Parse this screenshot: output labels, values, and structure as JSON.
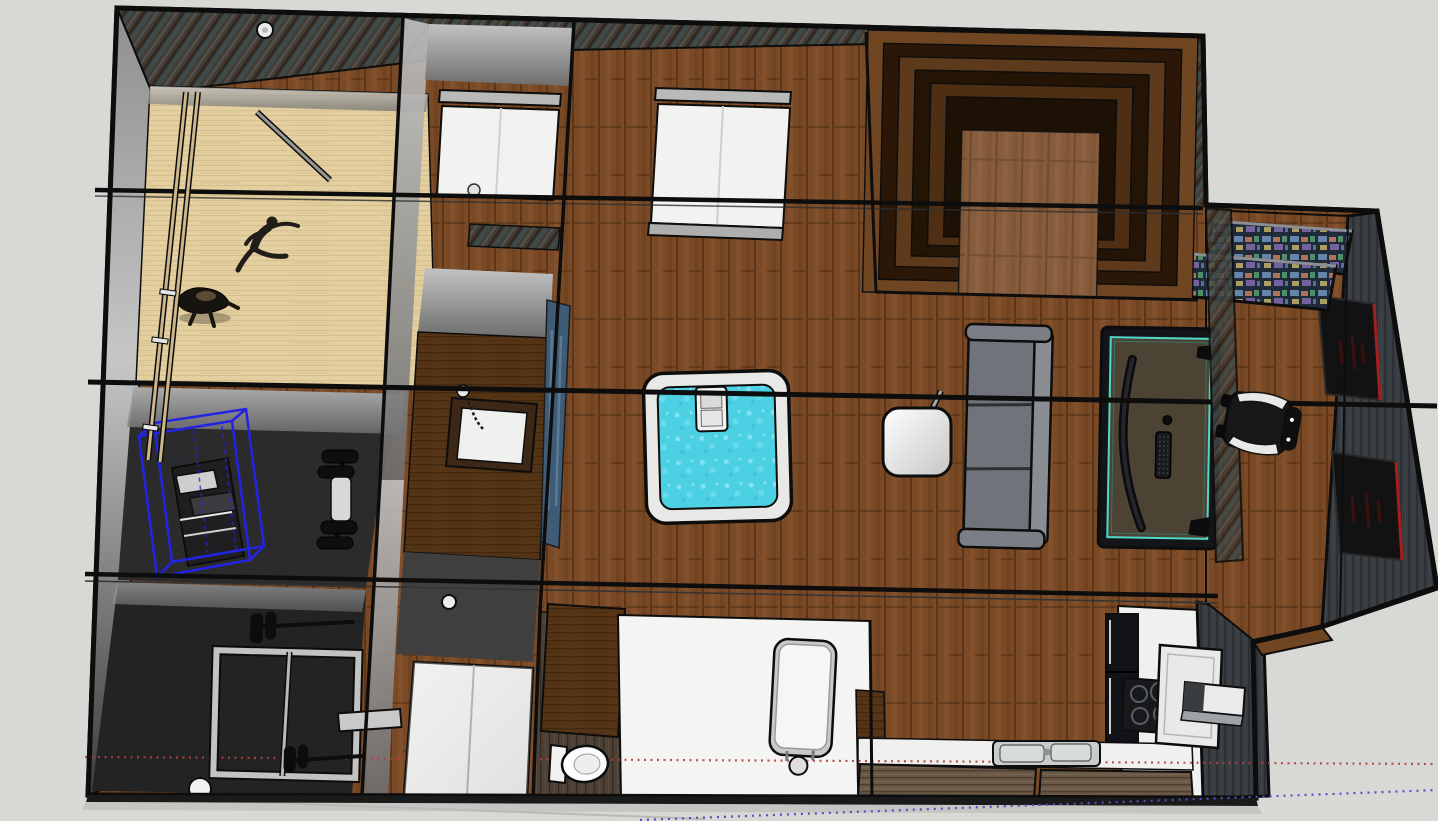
{
  "app": {
    "type": "3d-modeling-viewport",
    "style": "sketchup-like",
    "view": "top-down-perspective-floorplan"
  },
  "selection": {
    "selected_object": "treadmill-machine",
    "selection_style": "blue-bounding-wireframe"
  },
  "axes": {
    "red_axis": {
      "style": "dotted",
      "orientation": "horizontal"
    },
    "blue_axis": {
      "style": "dotted",
      "orientation": "horizontal-sloped"
    }
  },
  "rooms": [
    {
      "id": "dance-studio",
      "floor": "maple"
    },
    {
      "id": "gym-upper",
      "floor": "dark"
    },
    {
      "id": "gym-lower",
      "floor": "dark"
    },
    {
      "id": "small-bedroom",
      "floor": "wood"
    },
    {
      "id": "vanity-room",
      "floor": "dark-wood"
    },
    {
      "id": "laundry-closet",
      "floor": "gray"
    },
    {
      "id": "toilet-room",
      "floor": "dark-plank"
    },
    {
      "id": "bathroom",
      "floor": "white"
    },
    {
      "id": "living-area",
      "floor": "wood-plank"
    },
    {
      "id": "open-bedroom",
      "floor": "wood-plank"
    },
    {
      "id": "tiered-lounge",
      "floor": "stepped-wood"
    },
    {
      "id": "kitchen",
      "floor": "white"
    },
    {
      "id": "gaming-annex",
      "floor": "wood-plank"
    }
  ],
  "objects": [
    {
      "id": "ballet-barre",
      "room": "dance-studio"
    },
    {
      "id": "stretch-rod",
      "room": "dance-studio"
    },
    {
      "id": "dancer-figure-1",
      "room": "dance-studio"
    },
    {
      "id": "dancer-figure-2",
      "room": "dance-studio"
    },
    {
      "id": "treadmill-machine",
      "room": "gym-upper",
      "selected": true
    },
    {
      "id": "dumbbell-rack",
      "room": "gym-upper"
    },
    {
      "id": "squat-rack",
      "room": "gym-lower"
    },
    {
      "id": "round-plate",
      "room": "gym-lower"
    },
    {
      "id": "bed-small",
      "room": "small-bedroom"
    },
    {
      "id": "bed-double",
      "room": "open-bedroom"
    },
    {
      "id": "vanity-sink",
      "room": "vanity-room"
    },
    {
      "id": "hand-shower-hose",
      "room": "vanity-room"
    },
    {
      "id": "wall-art-blue",
      "room": "vanity-room"
    },
    {
      "id": "wardrobe-white",
      "room": "laundry-closet"
    },
    {
      "id": "toilet",
      "room": "toilet-room"
    },
    {
      "id": "bathtub",
      "room": "bathroom"
    },
    {
      "id": "hot-tub",
      "room": "living-area"
    },
    {
      "id": "floor-lamp",
      "room": "living-area"
    },
    {
      "id": "sofa",
      "room": "living-area"
    },
    {
      "id": "gaming-desk",
      "room": "living-area"
    },
    {
      "id": "curved-monitor",
      "room": "living-area"
    },
    {
      "id": "keyboard",
      "room": "living-area"
    },
    {
      "id": "mouse",
      "room": "living-area"
    },
    {
      "id": "gaming-chair",
      "room": "gaming-annex"
    },
    {
      "id": "media-screen-1",
      "room": "gaming-annex"
    },
    {
      "id": "media-screen-2",
      "room": "gaming-annex"
    },
    {
      "id": "poster-1",
      "room": "gaming-annex"
    },
    {
      "id": "poster-2",
      "room": "gaming-annex"
    },
    {
      "id": "kitchen-sink",
      "room": "kitchen"
    },
    {
      "id": "cooktop",
      "room": "kitchen"
    },
    {
      "id": "range-hood",
      "room": "kitchen"
    },
    {
      "id": "appliance-column",
      "room": "kitchen"
    },
    {
      "id": "kitchen-cabinets",
      "room": "kitchen"
    },
    {
      "id": "ceiling-light",
      "room": "various"
    }
  ],
  "colors": {
    "bg": "#d8d8d4",
    "bgShadow": "#b9b9b5",
    "edge": "#0d0d0d",
    "floorWood": "#7a4a26",
    "floorWoodLine": "#45260f",
    "floorWoodLight": "#8a5731",
    "floorWoodMid": "#6b3d1c",
    "floorMaple": "#e3cfa0",
    "mapleLineA": "#d6bf8c",
    "mapleLineB": "#cdb37c",
    "floorDark": "#2b2b2b",
    "floorDarker": "#232323",
    "floorWhite": "#f4f4f2",
    "wallTexBase": "#453c33",
    "wallTexTeal": "#3a5052",
    "wallTexLight": "#57646a",
    "wallTexDark": "#2d2620",
    "stripedWall": "#383d41",
    "stripeDark": "#2c3034",
    "stripeLight": "#454a4f",
    "toiletWood": "#4c4134",
    "toiletWoodDark": "#332b21",
    "toiletWoodLight": "#5d5142",
    "cabinetWood": "#6b5948",
    "cabinetLine": "#4a3b2c",
    "cabinetStreak": "#7d6a57",
    "vanityWood": "#563517",
    "vanityLine": "#3f250e",
    "water": "#4cd0e4",
    "waterLightA": "#9aeaf4",
    "waterLightB": "#7fe3f0",
    "waterDark": "#3db8cc",
    "rim": "#e8e8e6",
    "white": "#f2f2f0",
    "metal": "#c6c6c4",
    "steel": "#c9cccd",
    "sofa": "#70747a",
    "sofaLight": "#8a8e93",
    "sofaDark": "#2d2f33",
    "sofaArm": "#7b7f85",
    "deskTop": "#4c4335",
    "deskAccent": "#4fd9c8",
    "chairDark": "#17171a",
    "chairWhite": "#e8e8e6",
    "stepTopA": "#6f4522",
    "stepDark": "#2a1708",
    "stepTopB": "#5d3a1c",
    "stepDarkB": "#241405",
    "stepTopC": "#4f2f14",
    "stepDarkC": "#1d1004",
    "screenNavy": "#202b3a",
    "tileA": "#6f8fb8",
    "tileB": "#c97f5f",
    "tileC": "#57a874",
    "tileD": "#c4b36a",
    "tileE": "#8a6fb8",
    "posterDark": "#121212",
    "posterRed": "#a51d1d",
    "selBlue": "#2323e6",
    "axisRed": "#b43f3f",
    "axisBlue": "#5050c8",
    "barre": "#cdb68a",
    "wallFaceLight": "#c6c6c6",
    "wallFaceMid": "#8f8f8f",
    "wallFaceDark": "#3c3c3c",
    "roomFaceLight": "#c2c2c2",
    "roomFaceDark": "#6e6e6e",
    "applianceBlack": "#111318",
    "cooktopBlack": "#17191b",
    "burnerRing": "#5a5e62",
    "hood": "#e9e9e7",
    "artBlue": "#3f5c77",
    "bedHead": "#b9b9b7",
    "bedFoot": "#aeaeac",
    "crease": "#cfcfcd",
    "laundryFloor": "#3f3f3f",
    "wardrobeWhite": "#ececea",
    "machineDark": "#1f1f22"
  }
}
